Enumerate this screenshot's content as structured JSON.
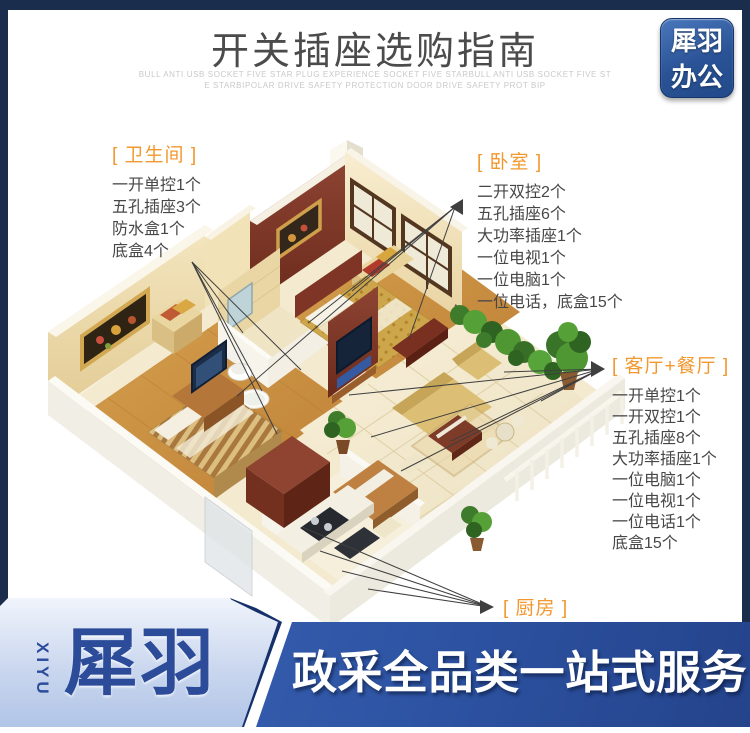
{
  "header": {
    "title": "开关插座选购指南",
    "subtitle_line1": "BULL ANTI USB SOCKET FIVE STAR PLUG EXPERIENCE SOCKET FIVE STARBULL ANTI USB SOCKET FIVE ST",
    "subtitle_line2": "E STARBIPOLAR DRIVE SAFETY PROTECTION DOOR  DRIVE SAFETY PROT BIP",
    "logo": {
      "line1": "犀羽",
      "line2": "办公"
    }
  },
  "annotations": {
    "bathroom": {
      "label": "[ 卫生间 ]",
      "items": [
        "一开单控1个",
        "五孔插座3个",
        "防水盒1个",
        "底盒4个"
      ]
    },
    "bedroom": {
      "label": "[ 卧室 ]",
      "items": [
        "二开双控2个",
        "五孔插座6个",
        "大功率插座1个",
        "一位电视1个",
        "一位电脑1个",
        "一位电话，底盒15个"
      ]
    },
    "living": {
      "label": "[ 客厅+餐厅 ]",
      "items": [
        "一开单控1个",
        "一开双控1个",
        "五孔插座8个",
        "大功率插座1个",
        "一位电脑1个",
        "一位电视1个",
        "一位电话1个",
        "底盒15个"
      ]
    },
    "kitchen": {
      "label": "[ 厨房 ]"
    }
  },
  "footer": {
    "brand_vertical": "XIYU",
    "brand_name": "犀羽",
    "slogan": "政采全品类一站式服务"
  },
  "colors": {
    "frame_navy": "#1b2d4d",
    "accent_orange": "#f2982f",
    "banner_blue": "#2e54a4",
    "logo_blue": "#2a5396",
    "title_gray": "#4b4b4b",
    "annotation_text": "#474747"
  }
}
